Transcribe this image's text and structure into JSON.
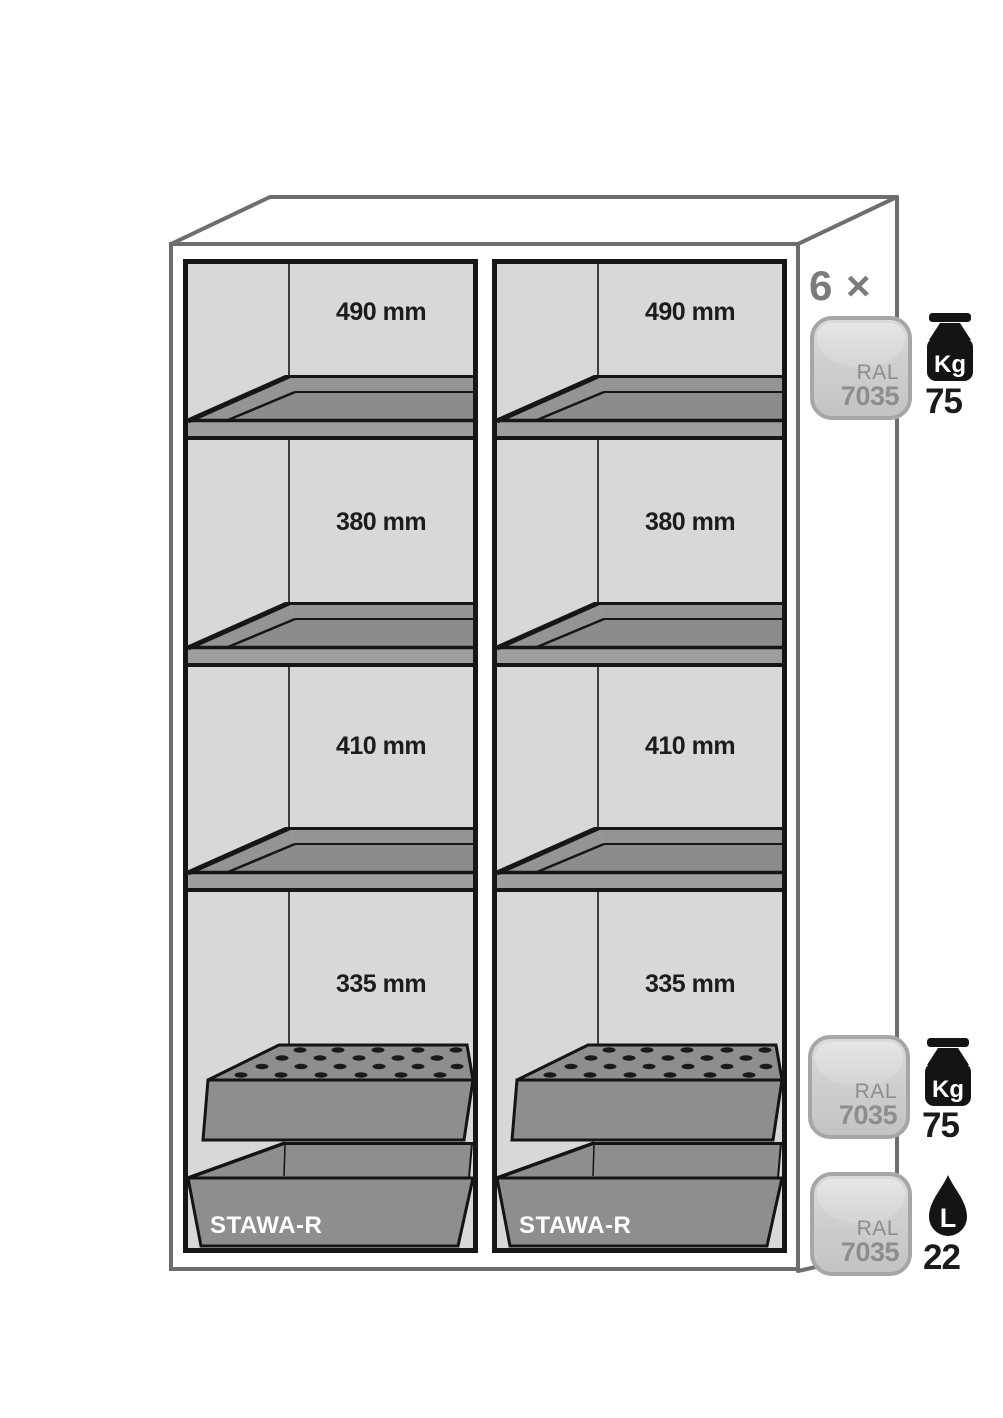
{
  "cabinet": {
    "compartments": [
      {
        "sections": [
          {
            "label": "490 mm"
          },
          {
            "label": "380 mm"
          },
          {
            "label": "410 mm"
          },
          {
            "label": "335 mm"
          }
        ],
        "sump_label": "STAWA-R"
      },
      {
        "sections": [
          {
            "label": "490 mm"
          },
          {
            "label": "380 mm"
          },
          {
            "label": "410 mm"
          },
          {
            "label": "335 mm"
          }
        ],
        "sump_label": "STAWA-R"
      }
    ]
  },
  "annotations": {
    "shelf_count_label": "6 ×",
    "shelf_badge": {
      "ral": "RAL",
      "code": "7035",
      "unit": "Kg",
      "value": "75"
    },
    "insert_badge": {
      "ral": "RAL",
      "code": "7035",
      "unit": "Kg",
      "value": "75"
    },
    "sump_badge": {
      "ral": "RAL",
      "code": "7035",
      "unit": "L",
      "value": "22"
    }
  },
  "colors": {
    "outline_gray": "#6e6e6e",
    "frame_black": "#161616",
    "interior_gray": "#d8d8d8",
    "shelf_surface_gray": "#8c8c8c",
    "shelf_rim_gray": "#949494",
    "shelf_bar_gray": "#9e9e9e",
    "insert_gray": "#8e8e8e",
    "badge_text_gray": "#8d8d8d",
    "count_gray": "#7b7b7b",
    "icon_black": "#141414",
    "label_black": "#1c1c1c"
  }
}
